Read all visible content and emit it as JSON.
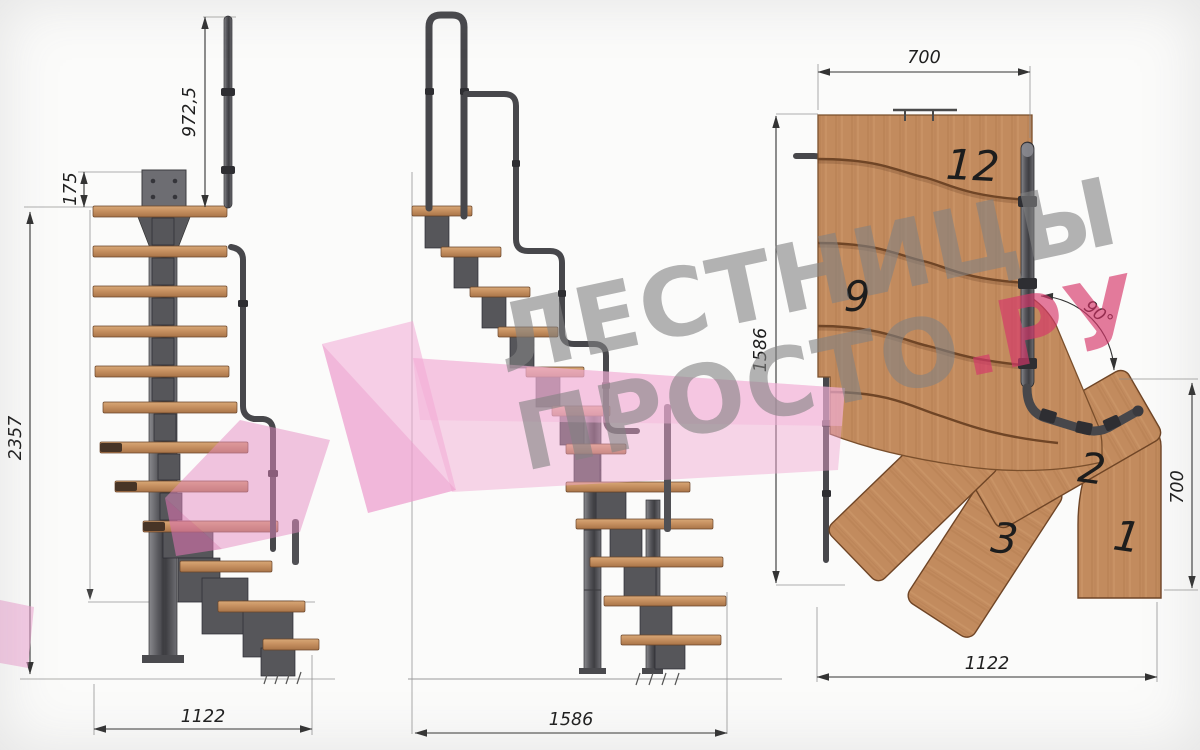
{
  "title": "Modular staircase technical drawing",
  "watermark": {
    "line1": "ЛЕСТНИЦЫ",
    "line2_gray": "ПРОСТО",
    "line2_pink": ".РУ",
    "gray_color": "#8f8f8f",
    "pink_color": "#d84f7a",
    "arrow_pink": "#f2aad6"
  },
  "front_view": {
    "dim_rail_height": "972,5",
    "dim_plate_height": "175",
    "dim_total_height": "2357",
    "dim_width": "1122"
  },
  "side_view": {
    "dim_width": "1586"
  },
  "plan_view": {
    "dim_top_width": "700",
    "dim_depth": "1586",
    "dim_angle": "90°",
    "dim_right_depth": "700",
    "dim_bottom_width": "1122",
    "step_labels": {
      "s12": "12",
      "s9": "9",
      "s3": "3",
      "s2": "2",
      "s1": "1"
    }
  },
  "colors": {
    "background": "#fbfbfa",
    "wood": "#c28b5e",
    "wood_dark": "#6f4526",
    "metal": "#56565a",
    "dimension_line": "#333333"
  }
}
